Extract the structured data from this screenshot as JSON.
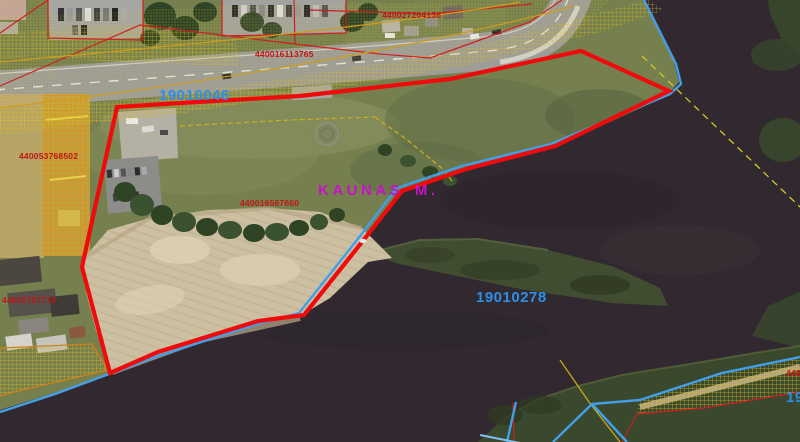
{
  "map": {
    "municipality_label": {
      "text": "KAUNAS M."
    },
    "cadastral_block_labels": [
      {
        "text": "19010046"
      },
      {
        "text": "19010278"
      },
      {
        "text": "19"
      }
    ],
    "parcel_number_labels": [
      {
        "text": "440027204136"
      },
      {
        "text": "440016113765"
      },
      {
        "text": "440053768502"
      },
      {
        "text": "440016567660"
      },
      {
        "text": "44005757710"
      },
      {
        "text": "4400"
      }
    ],
    "legend_colors": {
      "selected_parcel_boundary": "#ef0b0b",
      "hydrography_line": "#42a0ea",
      "cadastre_overlay": "#d8b820",
      "block_label": "#2d8fe8",
      "municipality_label": "#c712c7",
      "parcel_number_text": "#c41414"
    }
  }
}
